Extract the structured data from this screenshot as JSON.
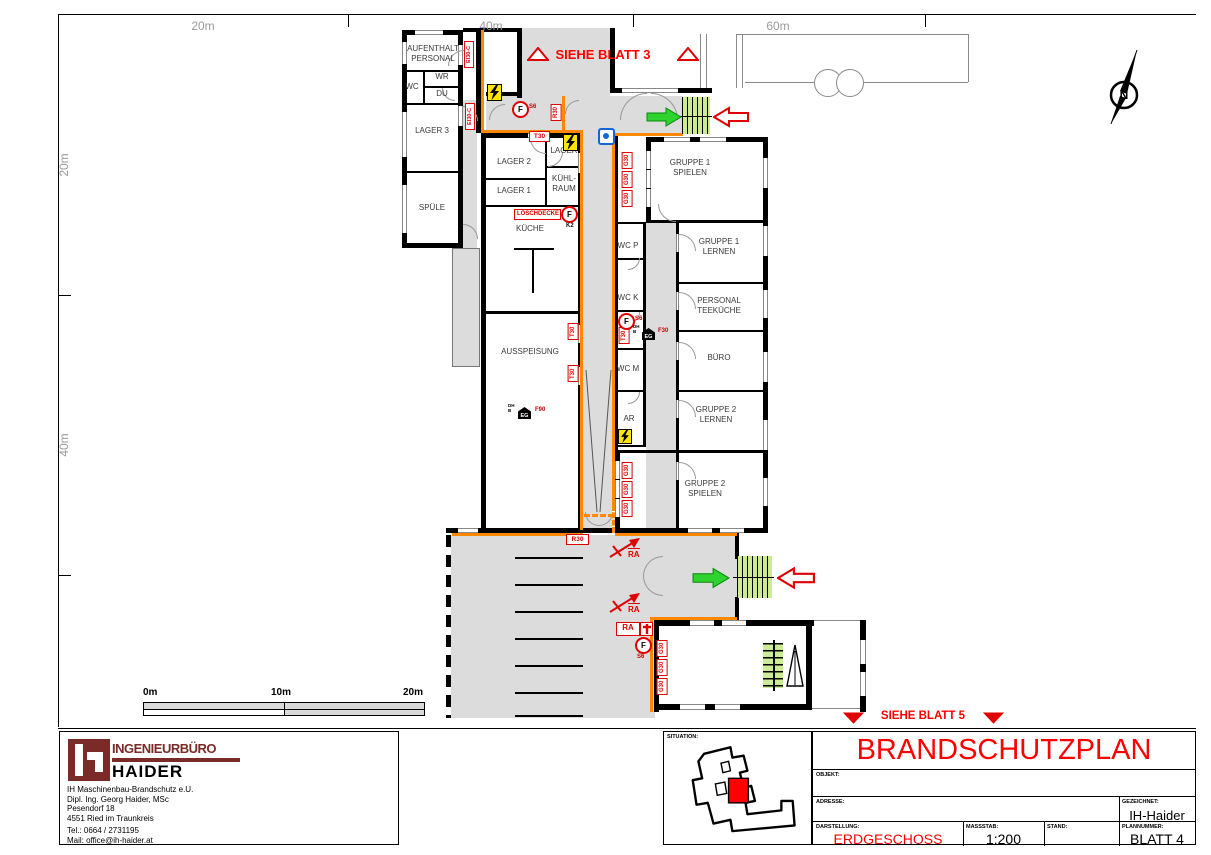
{
  "colors": {
    "accent_red": "#e00000",
    "title_red": "#ff0000",
    "escape_orange": "#ff8800",
    "corridor_gray": "#dcdcdc",
    "exit_green": "#2fd32f",
    "stair_highlight_green": "#cdeb94",
    "hydrant_blue": "#1565d8",
    "logo_maroon": "#7a2b27",
    "ruler_gray": "#9a9a9a"
  },
  "rulers": {
    "top": [
      "20m",
      "40m",
      "60m"
    ],
    "left": [
      "20m",
      "40m"
    ]
  },
  "scalebar": {
    "labels": [
      "0m",
      "10m",
      "20m"
    ]
  },
  "references": {
    "blatt3": "SIEHE BLATT 3",
    "blatt5": "SIEHE BLATT 5"
  },
  "compass": {
    "letter": "N"
  },
  "rooms": {
    "aufenthalt": "AUFENTHALT\nPERSONAL",
    "wc": "WC",
    "wr": "WR",
    "du": "DU",
    "lager3": "LAGER 3",
    "spuele": "SPÜLE",
    "lager2": "LAGER 2",
    "lager1": "LAGER 1",
    "lager": "LAGER",
    "kuehlraum": "KÜHL-\nRAUM",
    "kueche": "KÜCHE",
    "ausspeisung": "AUSSPEISUNG",
    "gruppe1_spielen": "GRUPPE 1\nSPIELEN",
    "gruppe1_lernen": "GRUPPE 1\nLERNEN",
    "personal_teekueche": "PERSONAL\nTEEKÜCHE",
    "buero": "BÜRO",
    "gruppe2_lernen": "GRUPPE 2\nLERNEN",
    "gruppe2_spielen": "GRUPPE 2\nSPIELEN",
    "wc_p": "WC P",
    "wc_k": "WC K",
    "wc_m": "WC M",
    "ar": "AR"
  },
  "fire": {
    "ei30c": "EI30-C",
    "t30": "T30",
    "r30": "R30",
    "g30": "G30",
    "f30": "F30",
    "f90": "F90",
    "ra": "RA",
    "loeschdecke": "LÖSCHDECKE",
    "f": "F",
    "s6": "S6",
    "k2": "K2",
    "dh": "DH",
    "b": "B",
    "eg": "EG"
  },
  "icons": {
    "lightning": "electrical-hazard",
    "extinguisher_circle": "fire-extinguisher",
    "blue_square_dot": "hydrant-marker",
    "green_arrow": "exit-direction",
    "red_outline_arrow": "access-direction",
    "ra_diagonal_arrow": "escape-route",
    "house_eg": "storey-marker",
    "north_needle": "north-arrow"
  },
  "titleblock": {
    "situation": "SITUATION:",
    "title": "BRANDSCHUTZPLAN",
    "objekt": "OBJEKT:",
    "adresse": "ADRESSE:",
    "gezeichnet": "GEZEICHNET:",
    "gezeichnet_value": "IH-Haider",
    "darstellung": "DARSTELLUNG:",
    "darstellung_value": "ERDGESCHOSS",
    "massstab": "MASSSTAB:",
    "massstab_value": "1:200",
    "stand": "STAND:",
    "plannummer": "PLANNUMMER:",
    "plannummer_value": "BLATT 4"
  },
  "company": {
    "brand_top": "INGENIEURBÜRO",
    "brand_bottom": "HAIDER",
    "line1": "IH Maschinenbau-Brandschutz e.U.",
    "line2": "Dipl. Ing. Georg Haider, MSc",
    "line3": "Pesendorf 18",
    "line4": "4551 Ried im Traunkreis",
    "line5": "Tel.: 0664 / 2731195",
    "line6": "Mail: office@ih-haider.at"
  }
}
